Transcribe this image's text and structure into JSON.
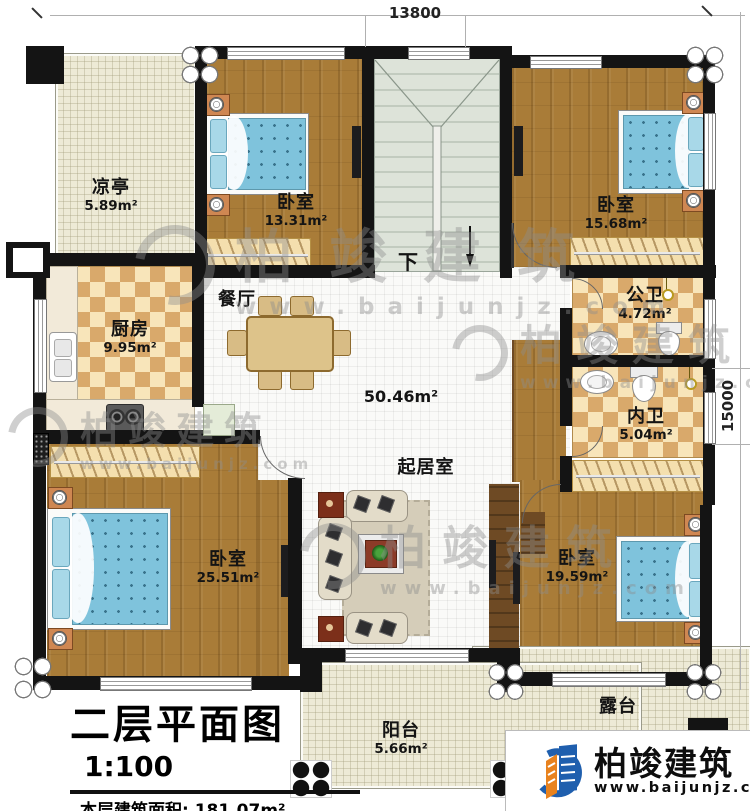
{
  "dimensions": {
    "top": "13800",
    "right": "15000"
  },
  "stairs": {
    "down_label": "下"
  },
  "rooms": {
    "liangting": {
      "name": "凉亭",
      "area": "5.89m²"
    },
    "bedroom_top_left": {
      "name": "卧室",
      "area": "13.31m²"
    },
    "bedroom_top_right": {
      "name": "卧室",
      "area": "15.68m²"
    },
    "kitchen": {
      "name": "厨房",
      "area": "9.95m²"
    },
    "dining": {
      "name": "餐厅"
    },
    "public_bath": {
      "name": "公卫",
      "area": "4.72m²"
    },
    "inner_bath": {
      "name": "内卫",
      "area": "5.04m²"
    },
    "living": {
      "name": "起居室",
      "area": "50.46m²"
    },
    "bedroom_bottom_left": {
      "name": "卧室",
      "area": "25.51m²"
    },
    "bedroom_bottom_right": {
      "name": "卧室",
      "area": "19.59m²"
    },
    "balcony": {
      "name": "阳台",
      "area": "5.66m²"
    },
    "terrace": {
      "name": "露台"
    }
  },
  "title_block": {
    "title": "二层平面图",
    "scale": "1:100",
    "floor_area": "本层建筑面积: 181.07m²",
    "floor_height": "层高: 3.6m"
  },
  "brand": {
    "name": "柏竣建筑",
    "website": "www.baijunjz.com"
  },
  "watermark": {
    "name": "柏竣建筑",
    "website": "www.baijunjz.com"
  },
  "colors": {
    "wall": "#141414",
    "wood": "#a97c38",
    "brand_blue": "#1f5fae",
    "brand_orange": "#e8821e"
  }
}
